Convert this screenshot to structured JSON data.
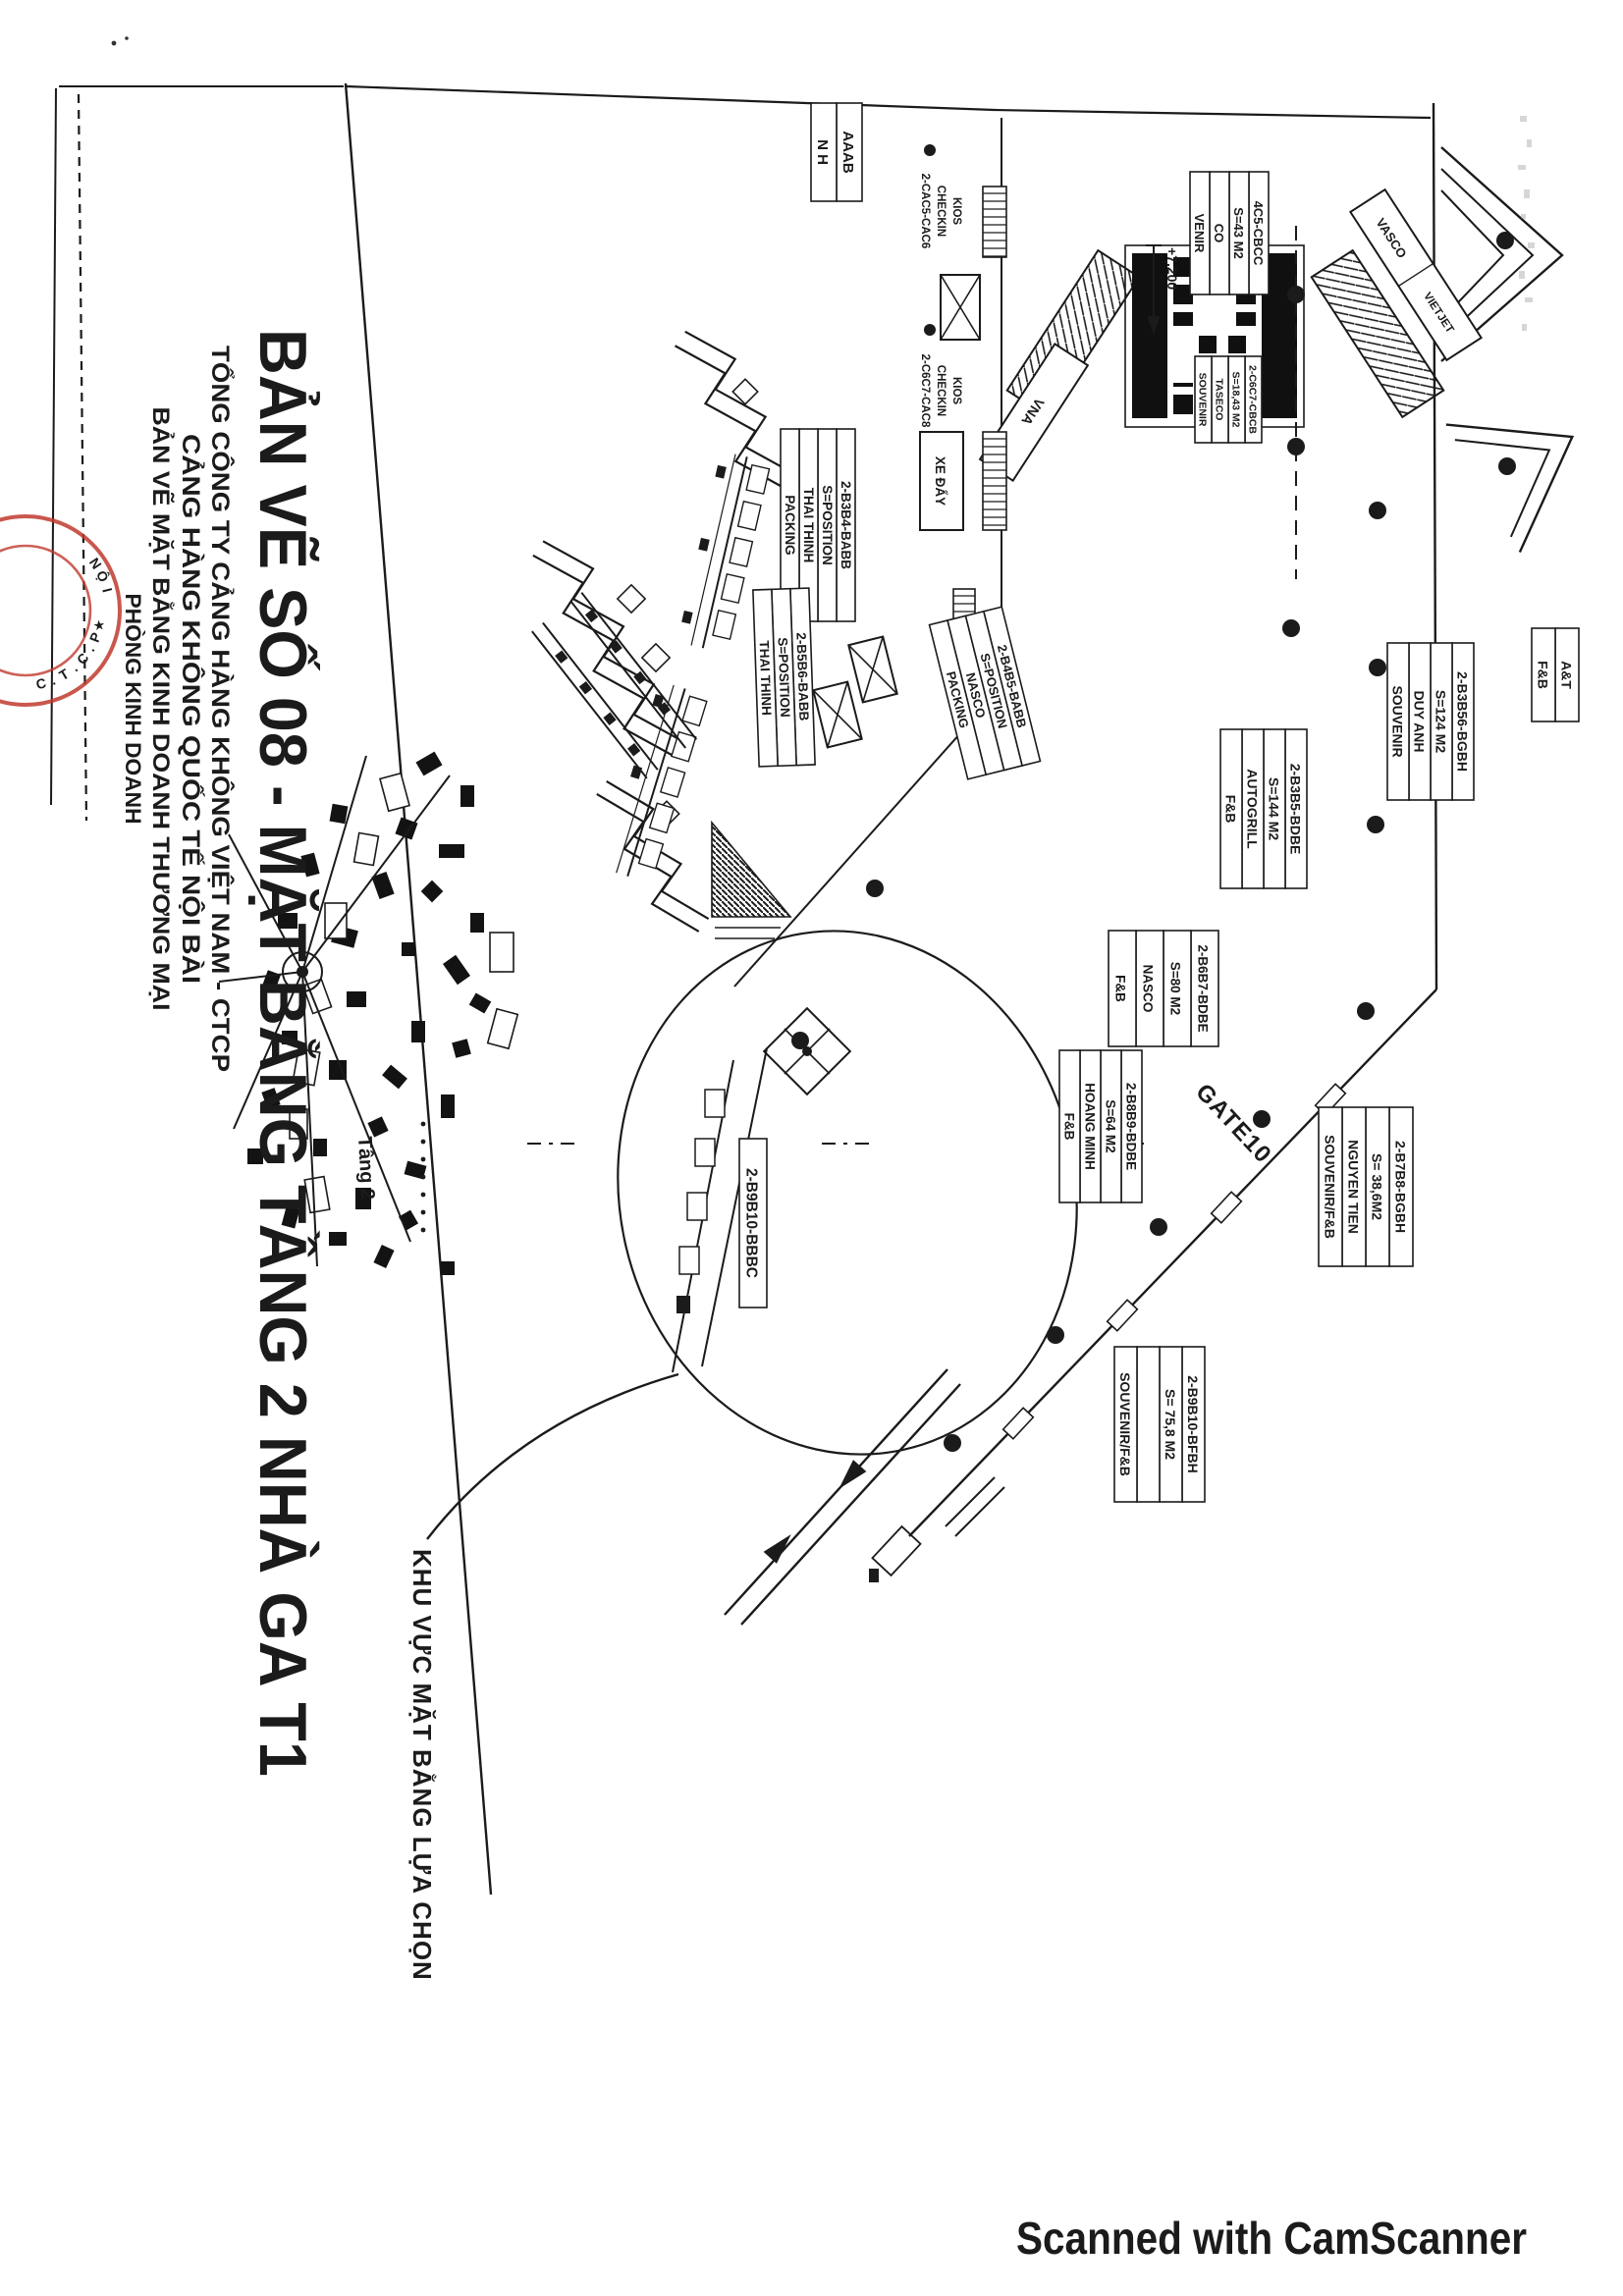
{
  "document": {
    "title": "BẢN VẼ SỐ 08 - MẶT BẰNG TẦNG 2 NHÀ GA T1",
    "header_lines": [
      "TỔNG CÔNG TY CẢNG HÀNG KHÔNG VIỆT NAM - CTCP",
      "CẢNG HÀNG KHÔNG QUỐC TẾ NỘI BÀI",
      "BẢN VẼ MẶT BẰNG KINH DOANH THƯƠNG MẠI",
      "PHÒNG KINH DOANH"
    ],
    "stamp": {
      "arc_text": "C.T.C.P",
      "star": "★",
      "inner_text": "IỘN"
    },
    "watermark": "Scanned with CamScanner"
  },
  "plan": {
    "floor_note": "Tầng 2",
    "selection_note": "KHU VỰC MẶT BẰNG LỰA CHỌN",
    "gate_label": "GATE10",
    "elevation_label": "+7.200",
    "cart_label": "XE ĐẨY",
    "counters": [
      {
        "label": "VASCO"
      },
      {
        "label": "VIETJET"
      },
      {
        "label": "VNA"
      }
    ],
    "kios_labels": [
      {
        "lines": [
          "KIOS",
          "CHECKIN",
          "2-CAC5-CAC6"
        ]
      },
      {
        "lines": [
          "KIOS",
          "CHECKIN",
          "2-C6C7-CAC8"
        ]
      }
    ],
    "unit_labels": [
      {
        "name": "thai-thinh-b3b4",
        "rows": [
          "2-B3B4-BABB",
          "S=POSITION",
          "THAI THINH",
          "PACKING"
        ]
      },
      {
        "name": "thai-thinh-b5b6",
        "rows": [
          "2-B5B6-BABB",
          "S=POSITION",
          "THAI THINH"
        ]
      },
      {
        "name": "nasco-b4b5",
        "rows": [
          "2-B4B5-BABB",
          "S=POSITION",
          "NASCO",
          "PACKING"
        ]
      },
      {
        "name": "duy-anh-b3b56",
        "rows": [
          "2-B3B56-BGBH",
          "S=124 M2",
          "DUY ANH",
          "SOUVENIR"
        ]
      },
      {
        "name": "autogrill-b3b5",
        "rows": [
          "2-B3B5-BDBE",
          "S=144 M2",
          "AUTOGRILL",
          "F&B"
        ]
      },
      {
        "name": "nasco-b6b7",
        "rows": [
          "2-B6B7-BDBE",
          "S=80 M2",
          "NASCO",
          "F&B"
        ]
      },
      {
        "name": "hoang-minh-b8b9",
        "rows": [
          "2-B8B9-BDBE",
          "S=64 M2",
          "HOANG MINH",
          "F&B"
        ]
      },
      {
        "name": "nguyen-tien-b7b8",
        "rows": [
          "2-B7B8-BGBH",
          "S= 38,6M2",
          "NGUYEN TIEN",
          "SOUVENIR/F&B"
        ]
      },
      {
        "name": "souvenir-b9b10",
        "rows": [
          "2-B9B10-BFBH",
          "S= 75,8 M2",
          "",
          "SOUVENIR/F&B"
        ]
      },
      {
        "name": "b9b10-bbbc",
        "rows": [
          "2-B9B10-BBBC"
        ]
      },
      {
        "name": "taseco-c4c5",
        "rows": [
          "4C5-CBCC",
          "S=43 M2",
          "CO",
          "VENIR"
        ]
      },
      {
        "name": "taseco-c6c7",
        "rows": [
          "2-C6C7-CBCB",
          "S=18,43 M2",
          "TASECO",
          "SOUVENIR"
        ]
      },
      {
        "name": "a-t-fb",
        "rows": [
          "A&T",
          "F&B"
        ]
      },
      {
        "name": "aaab",
        "rows": [
          "AAAB",
          "N H"
        ]
      }
    ]
  },
  "colors": {
    "ink": "#1b1b1b",
    "stamp_red": "#bf3a2e",
    "paper": "#ffffff"
  }
}
